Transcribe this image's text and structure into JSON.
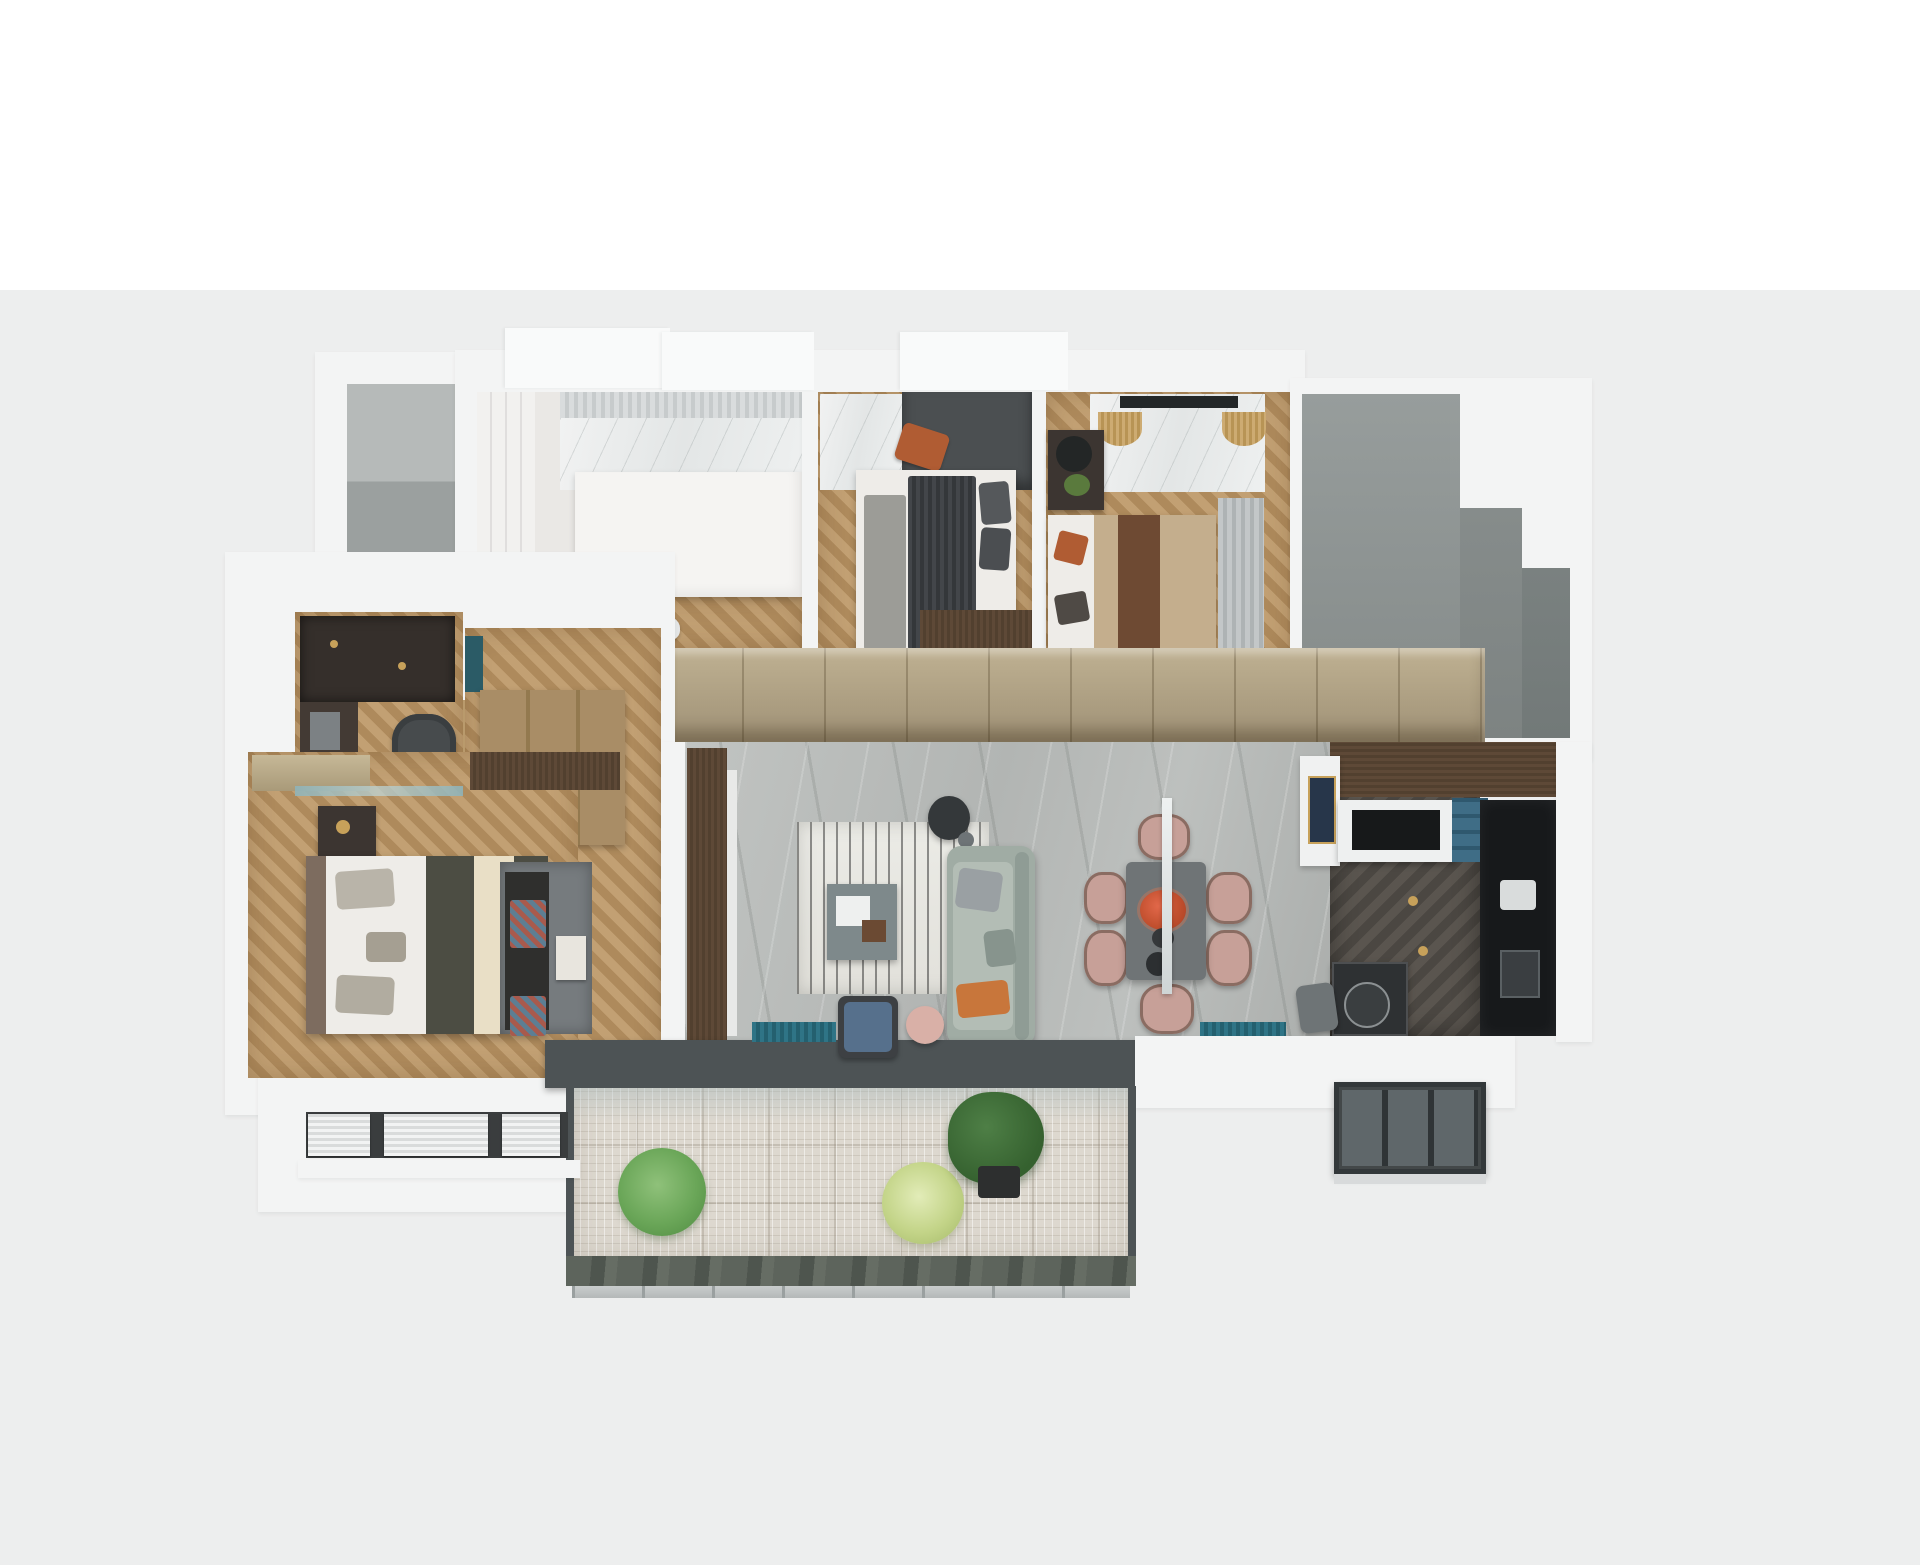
{
  "image_type": "3d_apartment_floor_plan_render",
  "scene": {
    "description": "Photorealistic top-down 3D render of a three-bedroom apartment floor plan, viewed from above, centered on a plain backdrop with no text or UI elements.",
    "view": "top-down isometric cutaway",
    "background_top": "#ffffff",
    "background_band": "#edeeee"
  },
  "palette": {
    "bg-band": "#edeeee",
    "wall": "#f3f4f4",
    "roof": "#f9fafa",
    "gray-room-a": "#b6bab9",
    "gray-room-b": "#9ba09f",
    "wood-a": "#c2a073",
    "wood-b": "#ae8a5c",
    "wardrobe-a": "#bfb192",
    "wardrobe-b": "#9f9176",
    "walnut-a": "#5e4937",
    "walnut-b": "#52402f",
    "walnut-dark": "#3c3531",
    "charcoal": "#4d5355",
    "teal-a": "#2f7486",
    "teal-b": "#24606f",
    "sofa": "#a0aca4",
    "sofa-seat": "#b3bdb5",
    "sofa-back": "#8f9c95",
    "orange": "#c8763b",
    "blush": "#c7a098",
    "blush-dark": "#8a6c62",
    "pouf": "#d9b0a7",
    "tablegray": "#6f7476",
    "bed-white": "#eeece8",
    "olive": "#4c4d43",
    "cream": "#e9dfc6",
    "rust": "#b05c33",
    "tanbed": "#c4ae8d",
    "runner": "#6e4a33",
    "rug-gray": "#767b7e",
    "deck": "#ddd8cf",
    "marble-dark": "#2e3133",
    "navy": "#27364a",
    "gold": "#c7a15a",
    "bookshelf": "#352f2b",
    "headboard": "#7d6c5f",
    "gray-panel": "#4b4f51"
  },
  "rooms": [
    {
      "id": "utility-room",
      "label": "Empty gray utility room at top left",
      "furniture": []
    },
    {
      "id": "kids-room",
      "label": "Kids bedroom with white bed, marble accent wall and sheer curtain",
      "furniture": [
        "built-in white wardrobe",
        "white bed with plush toy",
        "marble wall panel",
        "sheer curtain",
        "small white chair",
        "chevron wood floor"
      ]
    },
    {
      "id": "bedroom-2",
      "label": "Bedroom with dark striped bedding",
      "furniture": [
        "dark gray headboard wall",
        "marble panel",
        "double bed with striped charcoal duvet",
        "gray throw",
        "dark pillows",
        "rust accent pillow",
        "walnut dresser",
        "chevron wood floor"
      ]
    },
    {
      "id": "bedroom-3",
      "label": "Guest bedroom with tan and brown bedding",
      "furniture": [
        "marble TV wall",
        "wall TV",
        "two bamboo pendant lamps",
        "nightstand with black lamp and plant",
        "double bed with tan duvet and brown runner",
        "rust and brown pillows",
        "walnut bench",
        "gray curtain",
        "chevron wood floor"
      ]
    },
    {
      "id": "stair-core",
      "label": "Gray stepped stair core / elevator void at top right",
      "furniture": []
    },
    {
      "id": "home-office",
      "label": "Home office nook",
      "furniture": [
        "dark bookshelf wall with brass accents",
        "desk with monitor",
        "dark office chair",
        "chevron wood floor"
      ]
    },
    {
      "id": "master-suite",
      "label": "Master bedroom with dressing corridor",
      "furniture": [
        "tan closet",
        "wood wardrobe",
        "teal glass partition",
        "nightstand with brass lamp",
        "double bed with olive duvet and cream runner",
        "gray pillows",
        "dark foot bench with zigzag throws",
        "gray rug",
        "art card",
        "chevron wood floor"
      ]
    },
    {
      "id": "living-dining",
      "label": "Open-plan living and dining room on gray marble floor",
      "furniture": [
        "walnut TV console",
        "white striped rug",
        "teal-gray coffee table with tray and box",
        "black floor lamp",
        "sage green sofa with gray and orange pillows",
        "blue armchair",
        "blush pouf",
        "two teal window benches",
        "dark gray dining table for six",
        "six blush dining chairs",
        "flower centerpiece",
        "linear pendant light"
      ]
    },
    {
      "id": "hallway",
      "label": "Hallway with full-height tan wardrobe wall",
      "furniture": [
        "tan wardrobe band",
        "walnut entry door",
        "white console with navy-and-gold artwork"
      ]
    },
    {
      "id": "kitchen",
      "label": "Kitchen with dark cabinets and herringbone floor",
      "furniture": [
        "walnut upper cabinets",
        "white island with black cooktop",
        "blue open shelving",
        "black cabinet run with sink and appliance",
        "dark marble breakfast bar with round tray",
        "two brass pendant bulbs",
        "gray bar chair"
      ]
    },
    {
      "id": "main-balcony",
      "label": "Main balcony with patterned deck",
      "furniture": [
        "charcoal sliding-door track",
        "green shrub",
        "pale spiky grass plant",
        "potted fiddle-leaf fig",
        "green marble ledge",
        "glass railing"
      ]
    },
    {
      "id": "left-balcony",
      "label": "Utility balcony with white louvered AC units",
      "furniture": [
        "three louvered units"
      ]
    },
    {
      "id": "right-balcony",
      "label": "Glazed kitchen balcony with dark window frames",
      "furniture": [
        "dark framed glazing"
      ]
    }
  ]
}
